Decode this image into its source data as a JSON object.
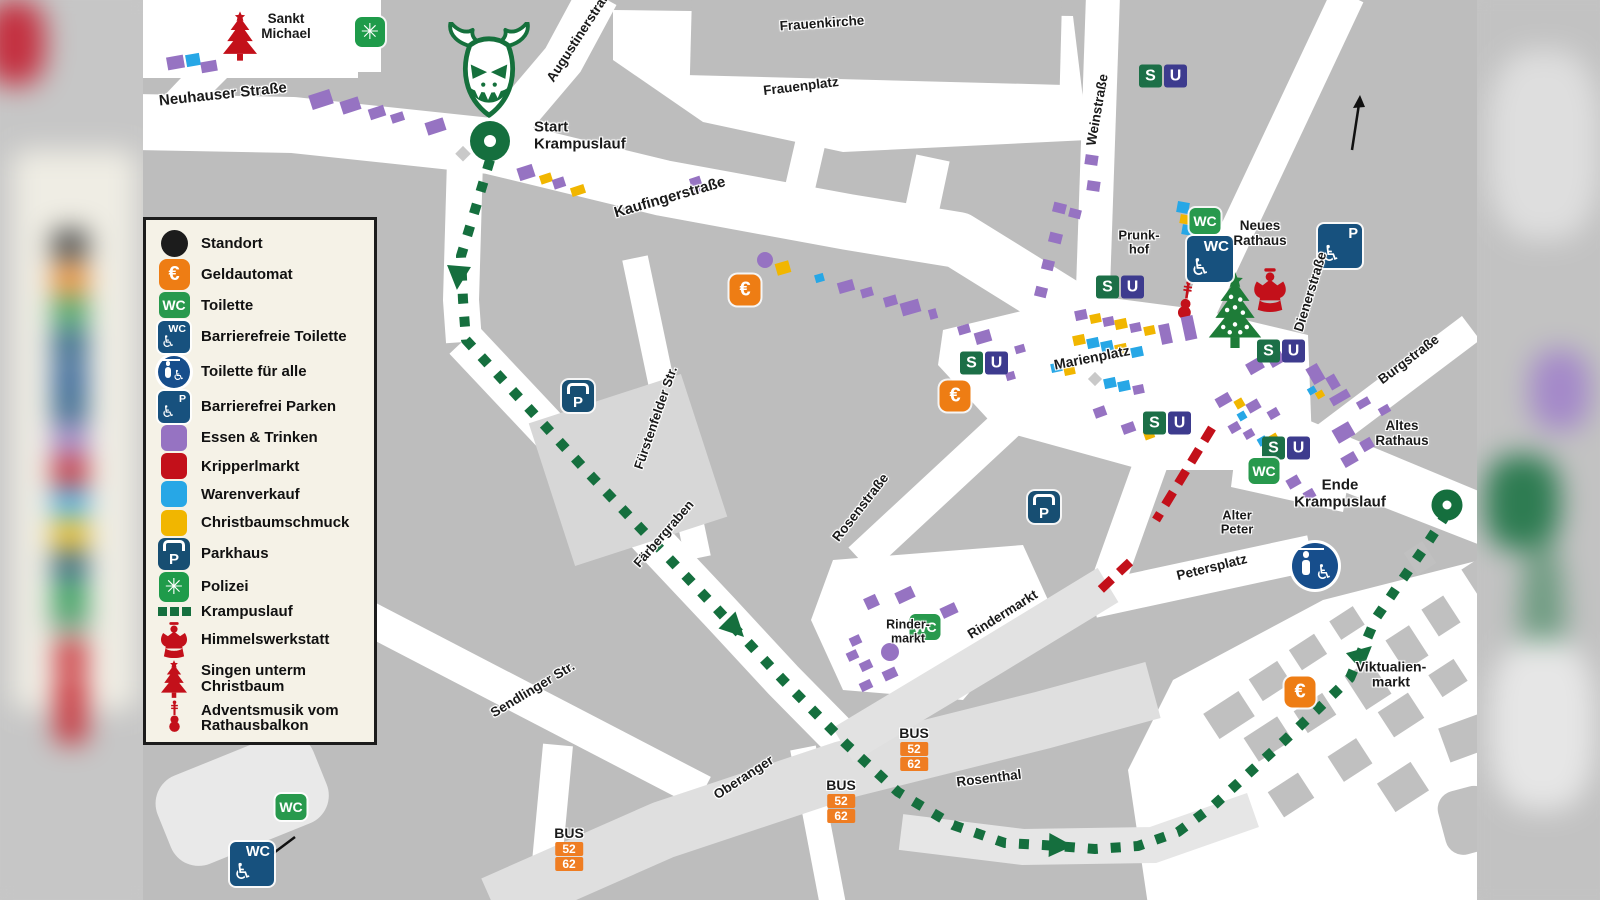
{
  "colors": {
    "route_green": "#156F3E",
    "wc_green": "#28994D",
    "s_green": "#1C6F47",
    "u_indigo": "#3D3B8E",
    "polizei_green": "#1F9B4A",
    "euro_orange": "#EE7D14",
    "bus_orange": "#EF7D22",
    "warenverkauf_blue": "#27A7E6",
    "christbaumschmuck_yellow": "#F1B600",
    "essen_trinken_purple": "#9673C2",
    "kripperlmarkt_red": "#C3101A",
    "accessible_navy": "#17517E",
    "parkhaus_navy": "#174E72",
    "street_white": "#FFFFFF",
    "building_gray": "#BDBDBD"
  },
  "icons": {
    "wc": "WC",
    "s": "S",
    "u": "U",
    "p": "P",
    "euro": "€",
    "bus": "BUS",
    "bus_lines": [
      "52",
      "62"
    ],
    "polizei_star": "✳",
    "wheelchair": "♿"
  },
  "legend": {
    "items": [
      {
        "type": "dot",
        "label": "Standort"
      },
      {
        "type": "euro",
        "label": "Geldautomat"
      },
      {
        "type": "wc",
        "label": "Toilette"
      },
      {
        "type": "wca",
        "label": "Barrierefreie Toilette"
      },
      {
        "type": "ta",
        "label": "Toilette für alle"
      },
      {
        "type": "pa",
        "label": "Barrierefrei Parken"
      },
      {
        "type": "food",
        "label": "Essen & Trinken"
      },
      {
        "type": "kripperl",
        "label": "Kripperlmarkt"
      },
      {
        "type": "waren",
        "label": "Warenverkauf"
      },
      {
        "type": "christbaum",
        "label": "Christbaumschmuck"
      },
      {
        "type": "ph",
        "label": "Parkhaus"
      },
      {
        "type": "pol",
        "label": "Polizei"
      },
      {
        "type": "dash",
        "label": "Krampuslauf"
      },
      {
        "type": "angel",
        "label": "Himmelswerkstatt"
      },
      {
        "type": "tree",
        "label": "Singen unterm\nChristbaum"
      },
      {
        "type": "violin",
        "label": "Adventsmusik vom\nRathausbalkon"
      }
    ]
  },
  "map": {
    "labels": [
      {
        "id": "sankt-michael",
        "text": "Sankt\nMichael",
        "x": 143,
        "y": 27,
        "r": 0,
        "s": 13.5
      },
      {
        "id": "neuhauser-strasse",
        "text": "Neuhauser Straße",
        "x": 80,
        "y": 95,
        "r": -6,
        "s": 15
      },
      {
        "id": "augustinerstrasse",
        "text": "Augustinerstraße",
        "x": 438,
        "y": 34,
        "r": -57,
        "s": 13.5
      },
      {
        "id": "start-krampuslauf",
        "text": "Start\nKrampuslauf",
        "x": 391,
        "y": 136,
        "r": 0,
        "s": 15,
        "align": "l"
      },
      {
        "id": "frauenkirche",
        "text": "Frauenkirche",
        "x": 679,
        "y": 24,
        "r": -4,
        "s": 13.5
      },
      {
        "id": "frauenplatz",
        "text": "Frauenplatz",
        "x": 658,
        "y": 87,
        "r": -7,
        "s": 13.5
      },
      {
        "id": "kaufingerstrasse",
        "text": "Kaufingerstraße",
        "x": 527,
        "y": 198,
        "r": -16,
        "s": 15
      },
      {
        "id": "weinstrasse",
        "text": "Weinstraße",
        "x": 955,
        "y": 110,
        "r": -80,
        "s": 13.5
      },
      {
        "id": "prunkhof",
        "text": "Prunk-\nhof",
        "x": 996,
        "y": 243,
        "r": 0,
        "s": 13
      },
      {
        "id": "neues-rathaus",
        "text": "Neues\nRathaus",
        "x": 1117,
        "y": 234,
        "r": 0,
        "s": 13.5
      },
      {
        "id": "dienerstrasse",
        "text": "Dienerstraße",
        "x": 1168,
        "y": 292,
        "r": -73,
        "s": 13.5
      },
      {
        "id": "burgstrasse",
        "text": "Burgstraße",
        "x": 1266,
        "y": 360,
        "r": -37,
        "s": 13.5
      },
      {
        "id": "marienplatz",
        "text": "Marienplatz",
        "x": 949,
        "y": 358,
        "r": -11,
        "s": 14
      },
      {
        "id": "altes-rathaus",
        "text": "Altes\nRathaus",
        "x": 1259,
        "y": 434,
        "r": 0,
        "s": 13.5
      },
      {
        "id": "ende-krampuslauf",
        "text": "Ende\nKrampuslauf",
        "x": 1197,
        "y": 494,
        "r": 0,
        "s": 15
      },
      {
        "id": "alter-peter",
        "text": "Alter\nPeter",
        "x": 1094,
        "y": 523,
        "r": 0,
        "s": 13
      },
      {
        "id": "petersplatz",
        "text": "Petersplatz",
        "x": 1069,
        "y": 568,
        "r": -14,
        "s": 13.5
      },
      {
        "id": "rosenstrasse",
        "text": "Rosenstraße",
        "x": 718,
        "y": 508,
        "r": -52,
        "s": 13.5
      },
      {
        "id": "fuerstenfelder-str",
        "text": "Fürstenfelder Str.",
        "x": 513,
        "y": 418,
        "r": -71,
        "s": 13
      },
      {
        "id": "faerbergraben",
        "text": "Färbergraben",
        "x": 521,
        "y": 534,
        "r": -49,
        "s": 13
      },
      {
        "id": "sendlinger-str",
        "text": "Sendlinger Str.",
        "x": 390,
        "y": 690,
        "r": -31,
        "s": 13.5
      },
      {
        "id": "oberanger",
        "text": "Oberanger",
        "x": 601,
        "y": 778,
        "r": -33,
        "s": 13.5
      },
      {
        "id": "rosenthal",
        "text": "Rosenthal",
        "x": 846,
        "y": 779,
        "r": -7,
        "s": 13.5
      },
      {
        "id": "rindermarkt",
        "text": "Rindermarkt",
        "x": 860,
        "y": 615,
        "r": -32,
        "s": 13.5
      },
      {
        "id": "rinder-markt",
        "text": "Rinder-\nmarkt",
        "x": 765,
        "y": 632,
        "r": 0,
        "s": 12.5
      },
      {
        "id": "viktualienmarkt",
        "text": "Viktualien-\nmarkt",
        "x": 1248,
        "y": 675,
        "r": 0,
        "s": 14
      }
    ],
    "markers": {
      "su_pairs": [
        {
          "x": 1020,
          "y": 76
        },
        {
          "x": 977,
          "y": 287
        },
        {
          "x": 841,
          "y": 363
        },
        {
          "x": 1024,
          "y": 423
        },
        {
          "x": 1138,
          "y": 351
        },
        {
          "x": 1143,
          "y": 448
        }
      ],
      "wc": [
        {
          "x": 1062,
          "y": 221
        },
        {
          "x": 1121,
          "y": 471
        },
        {
          "x": 782,
          "y": 627
        },
        {
          "x": 148,
          "y": 807
        }
      ],
      "wc_accessible": [
        {
          "x": 1067,
          "y": 259,
          "sz": 46
        },
        {
          "x": 109,
          "y": 818,
          "sz": 44
        }
      ],
      "toilette_alle": [
        {
          "x": 1172,
          "y": 476,
          "sz": 46
        }
      ],
      "euro": [
        {
          "x": 602,
          "y": 290
        },
        {
          "x": 812,
          "y": 396
        },
        {
          "x": 1157,
          "y": 692
        }
      ],
      "parkhaus": [
        {
          "x": 435,
          "y": 396
        },
        {
          "x": 901,
          "y": 507
        }
      ],
      "parken_accessible": [
        {
          "x": 1197,
          "y": 110,
          "sz": 44
        }
      ],
      "polizei": [
        {
          "x": 227,
          "y": 32
        }
      ],
      "bus_stops": [
        {
          "x": 426,
          "y": 848
        },
        {
          "x": 698,
          "y": 800
        },
        {
          "x": 771,
          "y": 748
        }
      ],
      "start": {
        "x": 347,
        "y": 141,
        "sz": 40
      },
      "ende": {
        "x": 1304,
        "y": 505,
        "sz": 31
      },
      "purple_circles": [
        {
          "x": 622,
          "y": 260,
          "r": 8
        },
        {
          "x": 747,
          "y": 652,
          "r": 9
        }
      ]
    },
    "stalls": [
      [
        32,
        62,
        17,
        13,
        -10,
        "p"
      ],
      [
        50,
        60,
        14,
        12,
        -10,
        "b"
      ],
      [
        66,
        66,
        16,
        11,
        -10,
        "p"
      ],
      [
        178,
        99,
        22,
        15,
        -18,
        "p"
      ],
      [
        207,
        105,
        19,
        13,
        -18,
        "p"
      ],
      [
        234,
        112,
        16,
        11,
        -18,
        "p"
      ],
      [
        254,
        117,
        13,
        9,
        -18,
        "p"
      ],
      [
        292,
        126,
        19,
        13,
        -18,
        "p"
      ],
      [
        383,
        172,
        16,
        13,
        -18,
        "p"
      ],
      [
        403,
        178,
        12,
        9,
        -18,
        "y"
      ],
      [
        416,
        183,
        12,
        10,
        -18,
        "p"
      ],
      [
        435,
        190,
        14,
        9,
        -18,
        "y"
      ],
      [
        553,
        184,
        11,
        15,
        -18,
        "p"
      ],
      [
        640,
        268,
        14,
        12,
        -16,
        "y"
      ],
      [
        676,
        278,
        9,
        8,
        -16,
        "b"
      ],
      [
        703,
        286,
        16,
        11,
        -16,
        "p"
      ],
      [
        724,
        292,
        12,
        9,
        -16,
        "p"
      ],
      [
        747,
        301,
        13,
        10,
        -16,
        "p"
      ],
      [
        767,
        307,
        19,
        13,
        -16,
        "p"
      ],
      [
        790,
        314,
        8,
        10,
        -16,
        "p"
      ],
      [
        821,
        329,
        12,
        9,
        -16,
        "p"
      ],
      [
        840,
        337,
        16,
        12,
        -16,
        "p"
      ],
      [
        877,
        349,
        10,
        8,
        -16,
        "p"
      ],
      [
        867,
        376,
        9,
        8,
        -16,
        "p"
      ],
      [
        948,
        160,
        13,
        10,
        8,
        "p"
      ],
      [
        950,
        186,
        13,
        10,
        8,
        "p"
      ],
      [
        916,
        208,
        13,
        10,
        14,
        "p"
      ],
      [
        932,
        213,
        12,
        9,
        14,
        "p"
      ],
      [
        912,
        238,
        13,
        10,
        14,
        "p"
      ],
      [
        905,
        265,
        12,
        10,
        14,
        "p"
      ],
      [
        898,
        292,
        12,
        10,
        14,
        "p"
      ],
      [
        1040,
        207,
        12,
        11,
        10,
        "b"
      ],
      [
        1042,
        219,
        11,
        9,
        10,
        "y"
      ],
      [
        1044,
        230,
        11,
        10,
        10,
        "b"
      ],
      [
        938,
        315,
        12,
        10,
        -12,
        "p"
      ],
      [
        952,
        318,
        11,
        9,
        -12,
        "y"
      ],
      [
        965,
        321,
        11,
        9,
        -12,
        "p"
      ],
      [
        978,
        324,
        12,
        10,
        -12,
        "y"
      ],
      [
        992,
        327,
        11,
        9,
        -12,
        "p"
      ],
      [
        1006,
        330,
        11,
        9,
        -12,
        "y"
      ],
      [
        936,
        340,
        12,
        10,
        -12,
        "y"
      ],
      [
        950,
        343,
        12,
        10,
        -12,
        "b"
      ],
      [
        964,
        346,
        12,
        10,
        -12,
        "b"
      ],
      [
        978,
        349,
        12,
        10,
        -12,
        "y"
      ],
      [
        994,
        352,
        12,
        10,
        -12,
        "b"
      ],
      [
        913,
        367,
        11,
        9,
        -12,
        "b"
      ],
      [
        926,
        370,
        11,
        9,
        -12,
        "y"
      ],
      [
        967,
        383,
        12,
        10,
        -12,
        "b"
      ],
      [
        981,
        386,
        12,
        10,
        -12,
        "b"
      ],
      [
        995,
        389,
        11,
        9,
        -12,
        "p"
      ],
      [
        1022,
        334,
        11,
        20,
        -12,
        "p"
      ],
      [
        1046,
        328,
        12,
        24,
        -12,
        "p"
      ],
      [
        957,
        412,
        12,
        10,
        -20,
        "p"
      ],
      [
        985,
        428,
        13,
        10,
        -20,
        "p"
      ],
      [
        1006,
        434,
        10,
        9,
        -20,
        "y"
      ],
      [
        1080,
        400,
        15,
        10,
        -30,
        "p"
      ],
      [
        1112,
        366,
        16,
        12,
        -30,
        "p"
      ],
      [
        1133,
        359,
        15,
        11,
        -30,
        "p"
      ],
      [
        1153,
        352,
        13,
        10,
        -30,
        "p"
      ],
      [
        1096,
        403,
        9,
        9,
        -30,
        "y"
      ],
      [
        1099,
        416,
        8,
        8,
        -30,
        "b"
      ],
      [
        1091,
        427,
        11,
        9,
        -30,
        "p"
      ],
      [
        1106,
        434,
        10,
        8,
        -30,
        "p"
      ],
      [
        1119,
        441,
        9,
        8,
        -30,
        "b"
      ],
      [
        1131,
        438,
        8,
        8,
        -30,
        "y"
      ],
      [
        1110,
        406,
        13,
        10,
        -30,
        "p"
      ],
      [
        1130,
        413,
        11,
        9,
        -30,
        "p"
      ],
      [
        1172,
        374,
        13,
        18,
        -30,
        "p"
      ],
      [
        1190,
        382,
        10,
        14,
        -30,
        "p"
      ],
      [
        1169,
        390,
        8,
        7,
        -30,
        "b"
      ],
      [
        1177,
        394,
        8,
        7,
        -30,
        "y"
      ],
      [
        1197,
        397,
        20,
        9,
        -30,
        "p"
      ],
      [
        1220,
        403,
        13,
        8,
        -30,
        "p"
      ],
      [
        1241,
        410,
        11,
        8,
        -30,
        "p"
      ],
      [
        1200,
        432,
        19,
        15,
        -30,
        "p"
      ],
      [
        1224,
        444,
        12,
        11,
        -30,
        "p"
      ],
      [
        1206,
        459,
        15,
        11,
        -30,
        "p"
      ],
      [
        1150,
        482,
        13,
        10,
        -30,
        "p"
      ],
      [
        1166,
        494,
        11,
        9,
        -30,
        "p"
      ],
      [
        762,
        595,
        18,
        12,
        -25,
        "p"
      ],
      [
        728,
        602,
        13,
        12,
        -25,
        "p"
      ],
      [
        806,
        610,
        16,
        11,
        -25,
        "p"
      ],
      [
        712,
        640,
        11,
        9,
        -25,
        "p"
      ],
      [
        709,
        655,
        11,
        9,
        -25,
        "p"
      ],
      [
        723,
        665,
        12,
        9,
        -25,
        "p"
      ],
      [
        747,
        674,
        14,
        10,
        -25,
        "p"
      ],
      [
        723,
        685,
        12,
        9,
        -25,
        "p"
      ]
    ]
  }
}
